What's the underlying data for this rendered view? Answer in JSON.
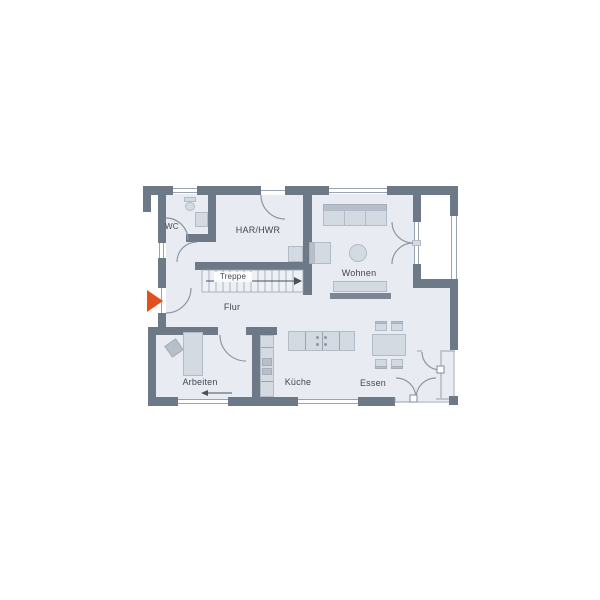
{
  "plan": {
    "rooms": {
      "wc": {
        "label": "WC"
      },
      "har_hwr": {
        "label": "HAR/HWR"
      },
      "treppe": {
        "label": "Treppe"
      },
      "wohnen": {
        "label": "Wohnen"
      },
      "flur": {
        "label": "Flur"
      },
      "arbeiten": {
        "label": "Arbeiten"
      },
      "kueche": {
        "label": "Küche"
      },
      "essen": {
        "label": "Essen"
      }
    },
    "markers": {
      "entrance": {
        "icon": "entrance-arrow",
        "direction": "right"
      },
      "stairs_direction": {
        "icon": "arrow-right"
      },
      "arbeiten_window": {
        "icon": "arrow-left"
      }
    },
    "colors": {
      "wall": "#6e7987",
      "floor": "#e8ecf2",
      "furniture": "#d3dae2",
      "furniture_dark": "#b7bfca",
      "line": "#8d97a4",
      "text": "#42474f",
      "accent": "#e2511d",
      "background": "#ffffff"
    }
  }
}
